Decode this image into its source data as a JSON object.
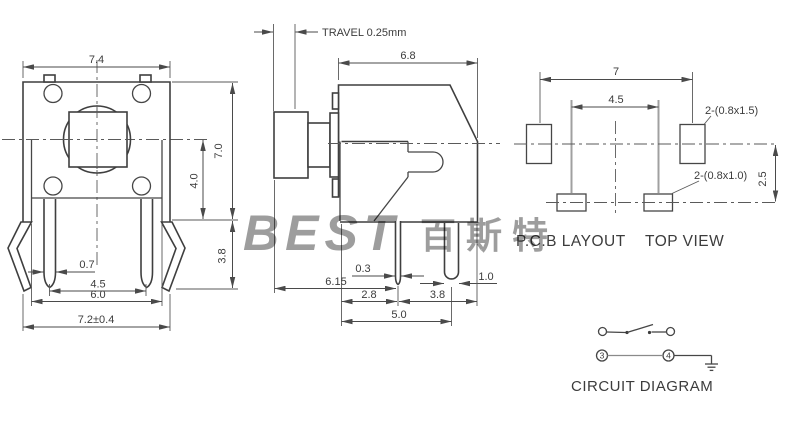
{
  "front": {
    "w_top": "7.4",
    "h": "7.0",
    "center_to_base": "4.0",
    "leg_h": "3.8",
    "pin_w": "0.7",
    "pin_pitch": "4.5",
    "bracket_w": "6.0",
    "base_w": "7.2±0.4"
  },
  "side": {
    "travel": "TRAVEL 0.25mm",
    "depth": "6.8",
    "pin_w": "0.3",
    "btn_to_pin": "6.15",
    "front_to_pin": "2.8",
    "pin_to_back": "3.8",
    "base": "5.0",
    "leg_w": "1.0"
  },
  "pcb": {
    "pitch": "7",
    "inner_pitch": "4.5",
    "row_gap": "2.5",
    "pad_big_label": "2-(0.8x1.5)",
    "pad_small_label": "2-(0.8x1.0)",
    "caption_left": "P.C.B LAYOUT",
    "caption_right": "TOP  VIEW"
  },
  "circuit": {
    "n3": "3",
    "n4": "4",
    "caption": "CIRCUIT DIAGRAM"
  },
  "watermark": {
    "latin": "BEST",
    "cjk": "百斯特"
  }
}
